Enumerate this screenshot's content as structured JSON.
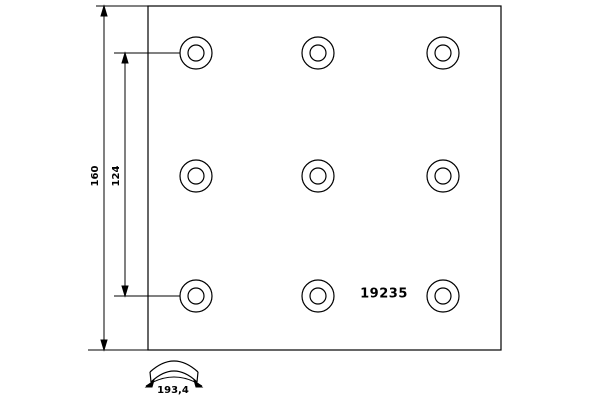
{
  "drawing": {
    "background": "#ffffff",
    "line_color": "#000000",
    "part_number": "19235",
    "dimensions": {
      "overall_width": "160",
      "hole_spacing": "124",
      "arc_width": "193,4"
    }
  }
}
